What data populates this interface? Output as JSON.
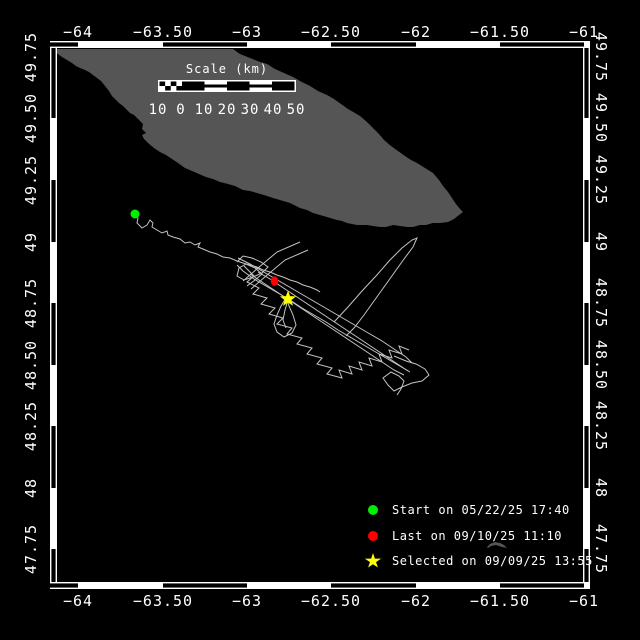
{
  "colors": {
    "background": "#000000",
    "frame": "#ffffff",
    "land": "#555555",
    "track": "#c4c4c4",
    "start_marker": "#00ee00",
    "last_marker": "#ff0000",
    "selected_marker": "#ffff00",
    "text": "#ffffff"
  },
  "frame": {
    "outer": [
      50,
      41,
      590,
      589
    ],
    "inner": [
      57,
      48,
      583,
      582
    ]
  },
  "lon_axis": {
    "ticks": [
      {
        "label": "−64",
        "x": 78
      },
      {
        "label": "−63.50",
        "x": 163
      },
      {
        "label": "−63",
        "x": 247
      },
      {
        "label": "−62.50",
        "x": 331
      },
      {
        "label": "−62",
        "x": 416
      },
      {
        "label": "−61.50",
        "x": 500
      },
      {
        "label": "−61",
        "x": 584
      }
    ],
    "top_label_baseline_y": 37,
    "bottom_label_baseline_y": 606,
    "black_segments": [
      [
        50,
        78
      ],
      [
        163,
        247
      ],
      [
        331,
        416
      ],
      [
        500,
        584
      ]
    ]
  },
  "lat_axis": {
    "ticks": [
      {
        "label": "49.75",
        "y": 57
      },
      {
        "label": "49.50",
        "y": 118
      },
      {
        "label": "49.25",
        "y": 180
      },
      {
        "label": "49",
        "y": 242
      },
      {
        "label": "48.75",
        "y": 303
      },
      {
        "label": "48.50",
        "y": 365
      },
      {
        "label": "48.25",
        "y": 426
      },
      {
        "label": "48",
        "y": 488
      },
      {
        "label": "47.75",
        "y": 549
      }
    ],
    "left_label_x": 31,
    "right_label_x": 601,
    "black_segments": [
      [
        48,
        118
      ],
      [
        180,
        242
      ],
      [
        303,
        365
      ],
      [
        426,
        488
      ],
      [
        549,
        582
      ]
    ]
  },
  "scale_bar": {
    "title": "Scale (km)",
    "title_x": 227,
    "title_y": 62,
    "bar": {
      "x": 158,
      "y": 80,
      "w": 138,
      "h": 12
    },
    "segment_styles": [
      "check",
      "black",
      "striped",
      "black",
      "striped",
      "black"
    ],
    "labels": [
      {
        "t": "10",
        "x": 158
      },
      {
        "t": "0",
        "x": 181
      },
      {
        "t": "10",
        "x": 204
      },
      {
        "t": "20",
        "x": 227
      },
      {
        "t": "30",
        "x": 250
      },
      {
        "t": "40",
        "x": 273
      },
      {
        "t": "50",
        "x": 296
      }
    ],
    "labels_baseline_y": 114
  },
  "legend": {
    "marker_cx": 373,
    "text_x": 392,
    "rows": [
      {
        "y": 510,
        "marker": "circle",
        "color": "#00ee00",
        "label": "Start on 05/22/25 17:40"
      },
      {
        "y": 536,
        "marker": "circle",
        "color": "#ff0000",
        "label": "Last on 09/10/25 11:10"
      },
      {
        "y": 561,
        "marker": "star",
        "color": "#ffff00",
        "label": "Selected on 09/09/25 13:55"
      }
    ]
  },
  "markers": {
    "start": {
      "shape": "circle",
      "color": "#00ee00",
      "x": 135,
      "y": 214,
      "r": 4.5
    },
    "last": {
      "shape": "ellipse",
      "color": "#ff0000",
      "x": 274.5,
      "y": 281,
      "rx": 3.8,
      "ry": 4.8
    },
    "selected": {
      "shape": "star",
      "color": "#ffff00",
      "x": 288,
      "y": 299,
      "r": 8.5,
      "r2": 3.5
    }
  },
  "land": {
    "anticosti": [
      [
        53,
        49
      ],
      [
        233,
        49
      ],
      [
        240,
        54
      ],
      [
        250,
        58
      ],
      [
        260,
        62
      ],
      [
        267,
        64
      ],
      [
        275,
        69
      ],
      [
        284,
        73
      ],
      [
        293,
        77
      ],
      [
        300,
        81
      ],
      [
        310,
        86
      ],
      [
        318,
        91
      ],
      [
        327,
        95
      ],
      [
        334,
        99
      ],
      [
        341,
        104
      ],
      [
        348,
        109
      ],
      [
        355,
        113
      ],
      [
        360,
        116
      ],
      [
        367,
        122
      ],
      [
        373,
        128
      ],
      [
        379,
        134
      ],
      [
        384,
        140
      ],
      [
        391,
        146
      ],
      [
        398,
        151
      ],
      [
        405,
        156
      ],
      [
        411,
        160
      ],
      [
        417,
        163
      ],
      [
        425,
        168
      ],
      [
        433,
        173
      ],
      [
        439,
        180
      ],
      [
        443,
        186
      ],
      [
        448,
        192
      ],
      [
        452,
        198
      ],
      [
        456,
        204
      ],
      [
        460,
        209
      ],
      [
        463,
        212
      ],
      [
        459,
        215
      ],
      [
        454,
        219
      ],
      [
        448,
        222
      ],
      [
        440,
        223
      ],
      [
        433,
        223
      ],
      [
        426,
        225
      ],
      [
        420,
        225
      ],
      [
        413,
        227
      ],
      [
        407,
        227
      ],
      [
        400,
        226
      ],
      [
        393,
        225
      ],
      [
        386,
        227
      ],
      [
        380,
        227
      ],
      [
        373,
        226
      ],
      [
        367,
        225
      ],
      [
        357,
        225
      ],
      [
        352,
        224
      ],
      [
        347,
        223
      ],
      [
        342,
        221
      ],
      [
        337,
        220
      ],
      [
        327,
        217
      ],
      [
        320,
        215
      ],
      [
        313,
        213
      ],
      [
        307,
        210
      ],
      [
        300,
        208
      ],
      [
        290,
        203
      ],
      [
        280,
        200
      ],
      [
        273,
        198
      ],
      [
        264,
        195
      ],
      [
        257,
        193
      ],
      [
        250,
        191
      ],
      [
        243,
        190
      ],
      [
        235,
        186
      ],
      [
        228,
        184
      ],
      [
        220,
        182
      ],
      [
        213,
        179
      ],
      [
        206,
        177
      ],
      [
        199,
        174
      ],
      [
        192,
        171
      ],
      [
        185,
        168
      ],
      [
        178,
        163
      ],
      [
        172,
        159
      ],
      [
        166,
        155
      ],
      [
        160,
        152
      ],
      [
        154,
        148
      ],
      [
        148,
        143
      ],
      [
        144,
        139
      ],
      [
        142,
        135
      ],
      [
        146,
        133
      ],
      [
        142,
        129
      ],
      [
        143,
        124
      ],
      [
        138,
        119
      ],
      [
        134,
        115
      ],
      [
        130,
        113
      ],
      [
        127,
        110
      ],
      [
        123,
        106
      ],
      [
        119,
        103
      ],
      [
        115,
        99
      ],
      [
        112,
        96
      ],
      [
        109,
        91
      ],
      [
        105,
        86
      ],
      [
        101,
        81
      ],
      [
        97,
        78
      ],
      [
        93,
        75
      ],
      [
        89,
        72
      ],
      [
        85,
        70
      ],
      [
        80,
        68
      ],
      [
        76,
        66
      ],
      [
        72,
        63
      ],
      [
        67,
        60
      ],
      [
        62,
        57
      ],
      [
        58,
        54
      ]
    ],
    "islets": [
      [
        [
          487,
          547
        ],
        [
          490,
          544
        ],
        [
          495,
          542
        ],
        [
          500,
          543
        ],
        [
          504,
          545
        ],
        [
          507,
          548
        ],
        [
          502,
          547
        ],
        [
          496,
          545
        ],
        [
          491,
          546
        ],
        [
          488,
          548
        ]
      ],
      [
        [
          478,
          588
        ],
        [
          483,
          584
        ],
        [
          489,
          582
        ],
        [
          496,
          583
        ],
        [
          502,
          584
        ],
        [
          508,
          585
        ],
        [
          513,
          587
        ],
        [
          507,
          588
        ],
        [
          499,
          587
        ],
        [
          491,
          588
        ],
        [
          484,
          589
        ],
        [
          479,
          589
        ]
      ]
    ]
  },
  "track": {
    "segments": [
      [
        [
          135,
          214
        ],
        [
          138,
          218
        ],
        [
          137,
          223
        ],
        [
          142,
          228
        ],
        [
          147,
          225
        ],
        [
          150,
          220
        ],
        [
          153,
          223
        ],
        [
          152,
          227
        ],
        [
          157,
          230
        ],
        [
          162,
          233
        ],
        [
          167,
          231
        ],
        [
          168,
          235
        ],
        [
          173,
          237
        ],
        [
          180,
          239
        ],
        [
          185,
          243
        ],
        [
          190,
          242
        ],
        [
          195,
          245
        ],
        [
          200,
          243
        ],
        [
          198,
          247
        ],
        [
          203,
          249
        ],
        [
          210,
          252
        ],
        [
          217,
          254
        ],
        [
          223,
          257
        ],
        [
          230,
          258
        ],
        [
          237,
          261
        ],
        [
          243,
          263
        ],
        [
          250,
          265
        ],
        [
          257,
          267
        ],
        [
          263,
          270
        ],
        [
          270,
          272
        ],
        [
          277,
          275
        ],
        [
          283,
          277
        ],
        [
          290,
          280
        ],
        [
          297,
          282
        ],
        [
          303,
          285
        ],
        [
          310,
          287
        ],
        [
          317,
          290
        ],
        [
          320,
          292
        ]
      ],
      [
        [
          238,
          258
        ],
        [
          250,
          264
        ],
        [
          262,
          271
        ],
        [
          274,
          278
        ],
        [
          286,
          285
        ],
        [
          298,
          292
        ],
        [
          310,
          299
        ],
        [
          322,
          306
        ],
        [
          334,
          313
        ],
        [
          346,
          320
        ],
        [
          358,
          327
        ],
        [
          370,
          334
        ],
        [
          382,
          341
        ],
        [
          394,
          349
        ],
        [
          406,
          357
        ],
        [
          412,
          363
        ]
      ],
      [
        [
          410,
          372
        ],
        [
          398,
          365
        ],
        [
          386,
          358
        ],
        [
          374,
          351
        ],
        [
          362,
          344
        ],
        [
          350,
          337
        ],
        [
          338,
          330
        ],
        [
          326,
          322
        ],
        [
          314,
          315
        ],
        [
          302,
          308
        ],
        [
          290,
          300
        ],
        [
          278,
          293
        ],
        [
          266,
          286
        ],
        [
          254,
          279
        ],
        [
          243,
          271
        ],
        [
          237,
          265
        ]
      ],
      [
        [
          244,
          266
        ],
        [
          254,
          276
        ],
        [
          247,
          282
        ],
        [
          259,
          288
        ],
        [
          253,
          294
        ],
        [
          267,
          298
        ],
        [
          261,
          304
        ],
        [
          275,
          308
        ],
        [
          269,
          314
        ],
        [
          283,
          318
        ],
        [
          277,
          324
        ],
        [
          292,
          328
        ],
        [
          287,
          334
        ],
        [
          302,
          338
        ],
        [
          297,
          344
        ],
        [
          312,
          348
        ],
        [
          307,
          354
        ],
        [
          322,
          358
        ],
        [
          317,
          364
        ],
        [
          332,
          368
        ],
        [
          327,
          374
        ],
        [
          342,
          378
        ],
        [
          339,
          370
        ],
        [
          352,
          374
        ],
        [
          349,
          366
        ],
        [
          362,
          370
        ],
        [
          359,
          362
        ],
        [
          372,
          366
        ],
        [
          369,
          358
        ],
        [
          382,
          362
        ],
        [
          379,
          354
        ],
        [
          392,
          358
        ],
        [
          389,
          350
        ],
        [
          402,
          354
        ],
        [
          399,
          346
        ],
        [
          409,
          350
        ]
      ],
      [
        [
          286,
          298
        ],
        [
          281,
          306
        ],
        [
          277,
          315
        ],
        [
          274,
          324
        ],
        [
          277,
          332
        ],
        [
          284,
          337
        ],
        [
          292,
          333
        ],
        [
          296,
          325
        ],
        [
          293,
          315
        ],
        [
          289,
          306
        ],
        [
          287,
          299
        ]
      ],
      [
        [
          334,
          322
        ],
        [
          348,
          307
        ],
        [
          362,
          291
        ],
        [
          376,
          276
        ],
        [
          390,
          260
        ],
        [
          402,
          248
        ],
        [
          412,
          240
        ],
        [
          417,
          238
        ],
        [
          413,
          247
        ],
        [
          404,
          259
        ],
        [
          394,
          273
        ],
        [
          384,
          287
        ],
        [
          374,
          301
        ],
        [
          364,
          315
        ],
        [
          354,
          328
        ],
        [
          346,
          336
        ]
      ],
      [
        [
          394,
          356
        ],
        [
          406,
          361
        ],
        [
          416,
          364
        ],
        [
          425,
          369
        ],
        [
          429,
          375
        ],
        [
          422,
          381
        ],
        [
          412,
          383
        ],
        [
          402,
          387
        ],
        [
          394,
          391
        ],
        [
          388,
          385
        ],
        [
          383,
          378
        ],
        [
          391,
          372
        ],
        [
          399,
          376
        ],
        [
          404,
          381
        ],
        [
          401,
          389
        ],
        [
          397,
          395
        ]
      ],
      [
        [
          237,
          262
        ],
        [
          243,
          256
        ],
        [
          252,
          258
        ],
        [
          261,
          262
        ],
        [
          268,
          267
        ],
        [
          262,
          273
        ],
        [
          253,
          277
        ],
        [
          244,
          280
        ],
        [
          237,
          276
        ],
        [
          239,
          268
        ],
        [
          246,
          264
        ],
        [
          255,
          268
        ],
        [
          262,
          274
        ],
        [
          255,
          280
        ],
        [
          247,
          286
        ]
      ],
      [
        [
          258,
          272
        ],
        [
          270,
          279
        ],
        [
          282,
          287
        ],
        [
          294,
          295
        ],
        [
          306,
          303
        ],
        [
          318,
          311
        ],
        [
          330,
          319
        ],
        [
          342,
          327
        ],
        [
          354,
          335
        ],
        [
          366,
          343
        ],
        [
          378,
          351
        ],
        [
          390,
          359
        ],
        [
          402,
          367
        ],
        [
          408,
          371
        ]
      ],
      [
        [
          250,
          274
        ],
        [
          262,
          282
        ],
        [
          274,
          290
        ],
        [
          286,
          298
        ],
        [
          298,
          306
        ],
        [
          310,
          314
        ],
        [
          322,
          322
        ],
        [
          334,
          330
        ],
        [
          346,
          338
        ],
        [
          358,
          346
        ],
        [
          370,
          354
        ],
        [
          382,
          362
        ],
        [
          394,
          370
        ],
        [
          404,
          375
        ]
      ],
      [
        [
          300,
          242
        ],
        [
          277,
          252
        ],
        [
          258,
          268
        ],
        [
          243,
          281
        ]
      ],
      [
        [
          308,
          250
        ],
        [
          285,
          260
        ],
        [
          266,
          276
        ],
        [
          251,
          289
        ]
      ],
      [
        [
          288,
          300
        ],
        [
          285,
          310
        ],
        [
          283,
          320
        ],
        [
          286,
          328
        ]
      ]
    ]
  }
}
